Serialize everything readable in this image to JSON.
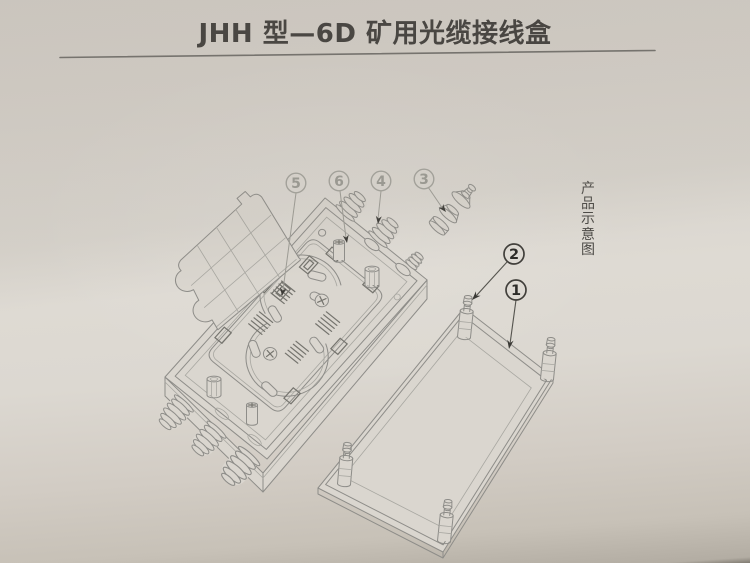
{
  "page": {
    "title": "JHH 型—6D 矿用光缆接线盒",
    "side_caption": "产品示意图",
    "side_caption_chars": [
      "产",
      "品",
      "示",
      "意",
      "图"
    ]
  },
  "callouts": [
    {
      "label": "1",
      "style": "dark"
    },
    {
      "label": "2",
      "style": "dark"
    },
    {
      "label": "3",
      "style": "light"
    },
    {
      "label": "4",
      "style": "light"
    },
    {
      "label": "5",
      "style": "light"
    },
    {
      "label": "6",
      "style": "light"
    }
  ],
  "colors": {
    "paper": "#dad6cf",
    "line": "#8e8d89",
    "dark_line": "#413f3b",
    "title_text": "#3e3c39",
    "callout_light": "#9b9a93",
    "callout_dark": "#2d2c29",
    "caption_text": "#4b4945"
  }
}
